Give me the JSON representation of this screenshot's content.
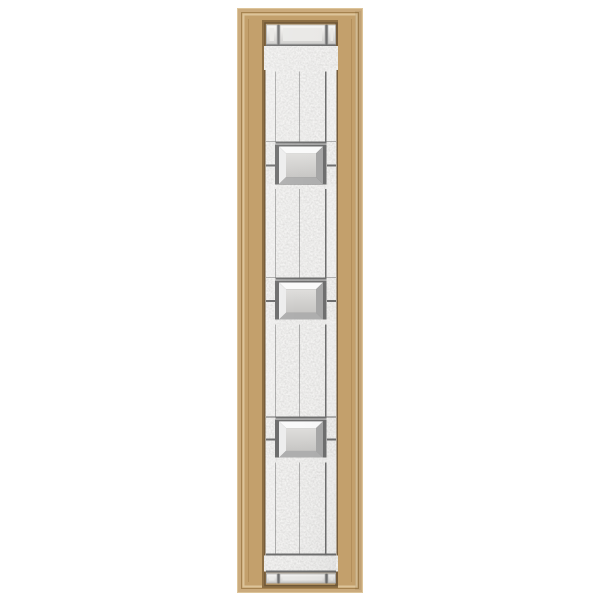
{
  "page": {
    "background": "#ffffff"
  },
  "product_image": {
    "subject": "decorative-glass-door-sidelight",
    "frame": {
      "finish": "tan",
      "rail_widths_px": {
        "left": 29,
        "right": 27,
        "top": 16,
        "bottom": 9
      }
    },
    "glass": {
      "style": "craftsman-geometric",
      "texture": "granite",
      "bevel_square_count": 3,
      "bevel_square_centers_y_px": [
        165,
        293,
        432
      ],
      "top_accent_row_pieces": 3,
      "bottom_accent_row_pieces": 3,
      "vertical_caming_lines": 3,
      "border_strips": 2
    }
  },
  "colors": {
    "page_bg": "#ffffff",
    "frame_base": "#c3a06c",
    "frame_light": "#dcc49a",
    "frame_mid": "#cbab7d",
    "frame_groove": "#a5824f",
    "frame_shadow": "#8c6e44",
    "frame_lip": "#6e5737",
    "caming": "#6d6d6d",
    "caming_highlight": "#dcdcdc",
    "bevel_top": "#fafafa",
    "bevel_left": "#ededed",
    "bevel_right": "#a6a6a6",
    "bevel_bottom": "#aeaeae",
    "bevel_center_light": "#dfdedc",
    "bevel_center_dark": "#c7c6c4",
    "clear_center": "#e9e8e6",
    "granite_tint": "#d8d6d3"
  }
}
